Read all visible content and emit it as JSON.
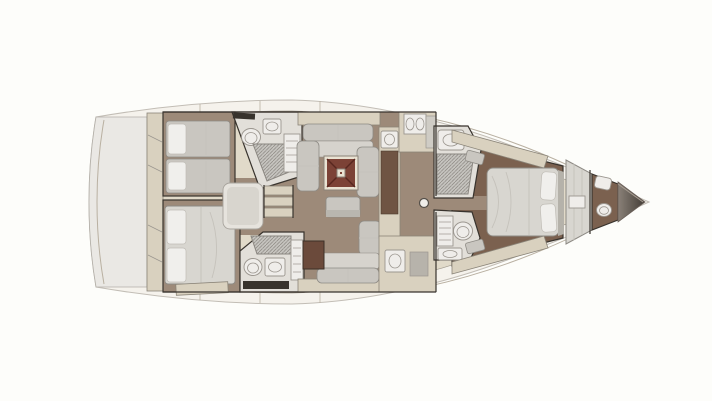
{
  "diagram": {
    "kind": "sailboat-interior-floor-plan",
    "view": "top-down",
    "orientation": "bow-right-stern-left",
    "colors": {
      "background": "#fdfdfa",
      "hull": "#f5f2ec",
      "hull_line": "#c2bdb5",
      "deck": "#e1dac9",
      "deck_line": "#a49d90",
      "seam": "#b9b0a1",
      "transom": "#eae8e4",
      "transom_line": "#b3afa8",
      "floor": "#9d8a79",
      "floor_dark": "#7b614f",
      "wall": "#38332d",
      "cabinet": "#d9d1bf",
      "cab_line": "#8a8478",
      "counter": "#6f5443",
      "counter_line": "#4c3a2e",
      "furniture": "#c9c6c0",
      "furniture_light": "#d6d3cd",
      "furn_line": "#8d8a84",
      "bed": "#d8d6d0",
      "pillow": "#f0efec",
      "pillow_line": "#c0bdb6",
      "white_fixture": "#efedea",
      "fixture_line": "#9b968f",
      "room_light": "#e2dfd9",
      "grate": "#c6c4bf",
      "grate_line": "#8b8781",
      "fold": "#c5c2bb",
      "table_frame": "#e9e2d2",
      "table_frame_line": "#8a8378",
      "table_top": "#7c4236",
      "table_cross": "#58271f",
      "dark_cabinet": "#6b4a3b",
      "dark_cabinet_line": "#3c3027",
      "partition": "#d8d6d0",
      "steel": "#b7b3ab",
      "bow_dark": "#423c36",
      "bow_mid": "#8a8178"
    },
    "areas": [
      {
        "id": "transom-platform"
      },
      {
        "id": "swim-steps"
      },
      {
        "id": "aft-cabin-port"
      },
      {
        "id": "aft-cabin-starboard"
      },
      {
        "id": "aft-head-port"
      },
      {
        "id": "aft-head-starboard"
      },
      {
        "id": "companionway"
      },
      {
        "id": "salon"
      },
      {
        "id": "galley"
      },
      {
        "id": "forward-head-port"
      },
      {
        "id": "forward-head-starboard"
      },
      {
        "id": "owner-cabin"
      },
      {
        "id": "bow-head"
      },
      {
        "id": "anchor-locker"
      }
    ],
    "fixtures": [
      {
        "id": "single-berth",
        "count": 2
      },
      {
        "id": "double-berth",
        "count": 2
      },
      {
        "id": "toilet",
        "count": 4
      },
      {
        "id": "sink",
        "count": 6
      },
      {
        "id": "shower-grate",
        "count": 4
      },
      {
        "id": "salon-table",
        "count": 1
      },
      {
        "id": "settee",
        "count": 2
      },
      {
        "id": "companionway-steps",
        "count": 1
      },
      {
        "id": "mast-post",
        "count": 1
      }
    ]
  }
}
